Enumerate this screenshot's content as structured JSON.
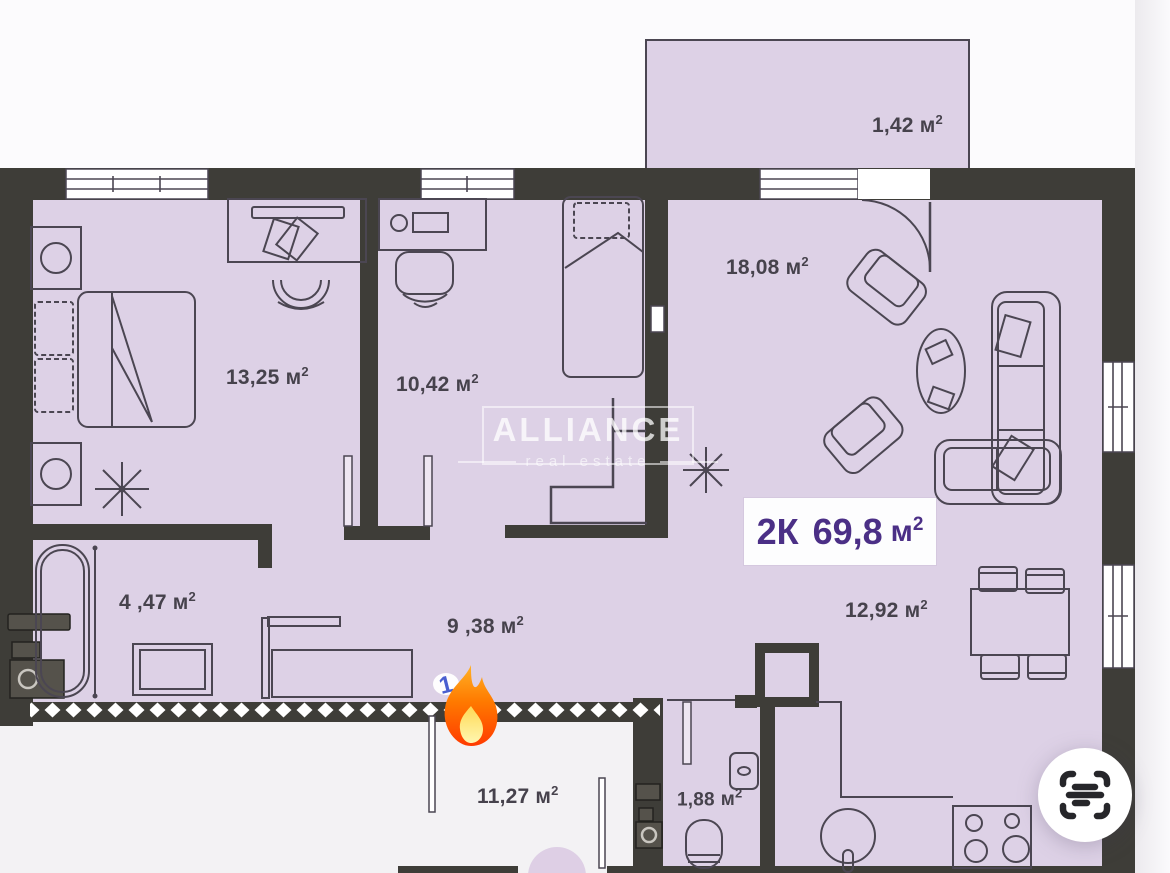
{
  "badge": {
    "rooms": "2К",
    "area": "69,8",
    "unit": "м",
    "sup": "2"
  },
  "unit": {
    "base": "м",
    "sup": "2"
  },
  "rooms": [
    {
      "key": "balcony",
      "area": "1,42"
    },
    {
      "key": "living",
      "area": "18,08"
    },
    {
      "key": "bedroom1",
      "area": "13,25"
    },
    {
      "key": "bedroom2",
      "area": "10,42"
    },
    {
      "key": "bathroom",
      "area": "4 ,47"
    },
    {
      "key": "hallway",
      "area": "9 ,38"
    },
    {
      "key": "dining",
      "area": "12,92"
    },
    {
      "key": "terrace",
      "area": "11,27"
    },
    {
      "key": "wc",
      "area": "1,88"
    }
  ],
  "watermark": {
    "name": "ALLIANCE",
    "tagline": "real estate"
  },
  "stickers": {
    "fire_count": "1"
  },
  "colors": {
    "wall": "#3e3d38",
    "floor": "#ddd1e6",
    "terrace": "#f3f2f4",
    "line": "#4b4652",
    "label_text": "#46424c",
    "badge_text": "#4b2f86",
    "fire_top": "#ffb226",
    "fire_bottom": "#ff3b00",
    "fire_inner": "#ffe477",
    "accent_blue": "#4a5fd0",
    "scan_glyph": "#26262a",
    "outside_strip": "#eceaee"
  }
}
